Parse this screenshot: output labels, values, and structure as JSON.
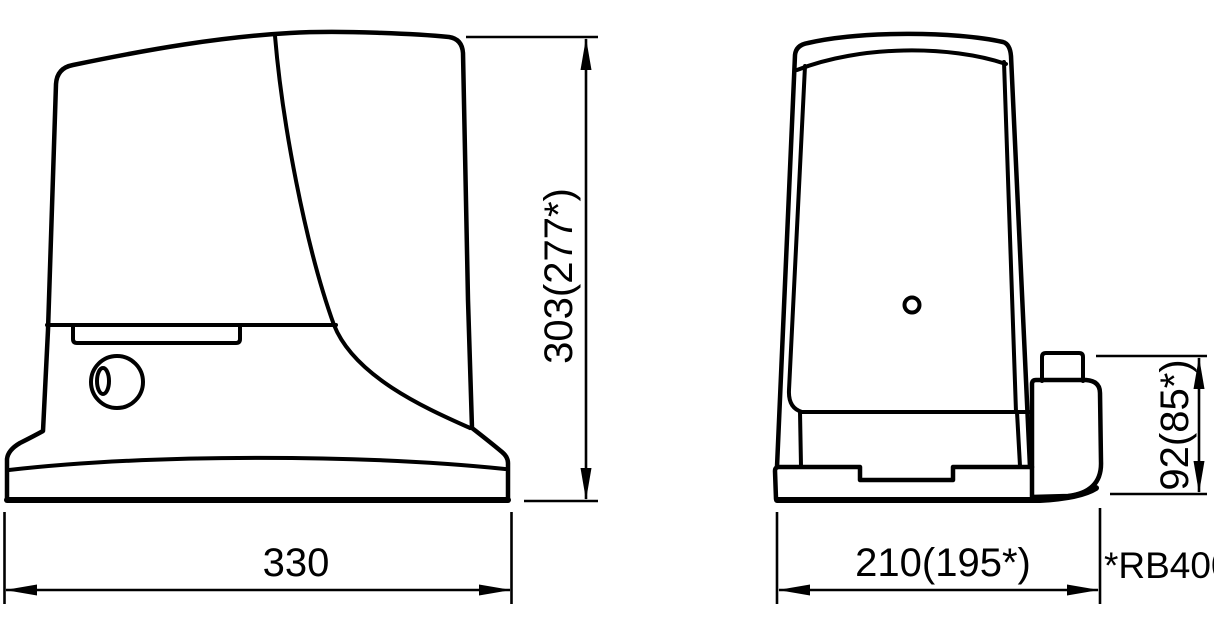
{
  "colors": {
    "background": "#ffffff",
    "line": "#000000"
  },
  "drawing": {
    "type": "technical-dimension-drawing",
    "views": [
      {
        "id": "side-view",
        "width_mm": "330",
        "height_mm": "303(277*)"
      },
      {
        "id": "front-view",
        "width_mm": "210(195*)",
        "motor_block_height_mm": "92(85*)"
      }
    ]
  },
  "labels": {
    "height_side": "303(277*)",
    "width_side": "330",
    "width_front": "210(195*)",
    "height_motor_block": "92(85*)",
    "model_note": "*RB400"
  }
}
